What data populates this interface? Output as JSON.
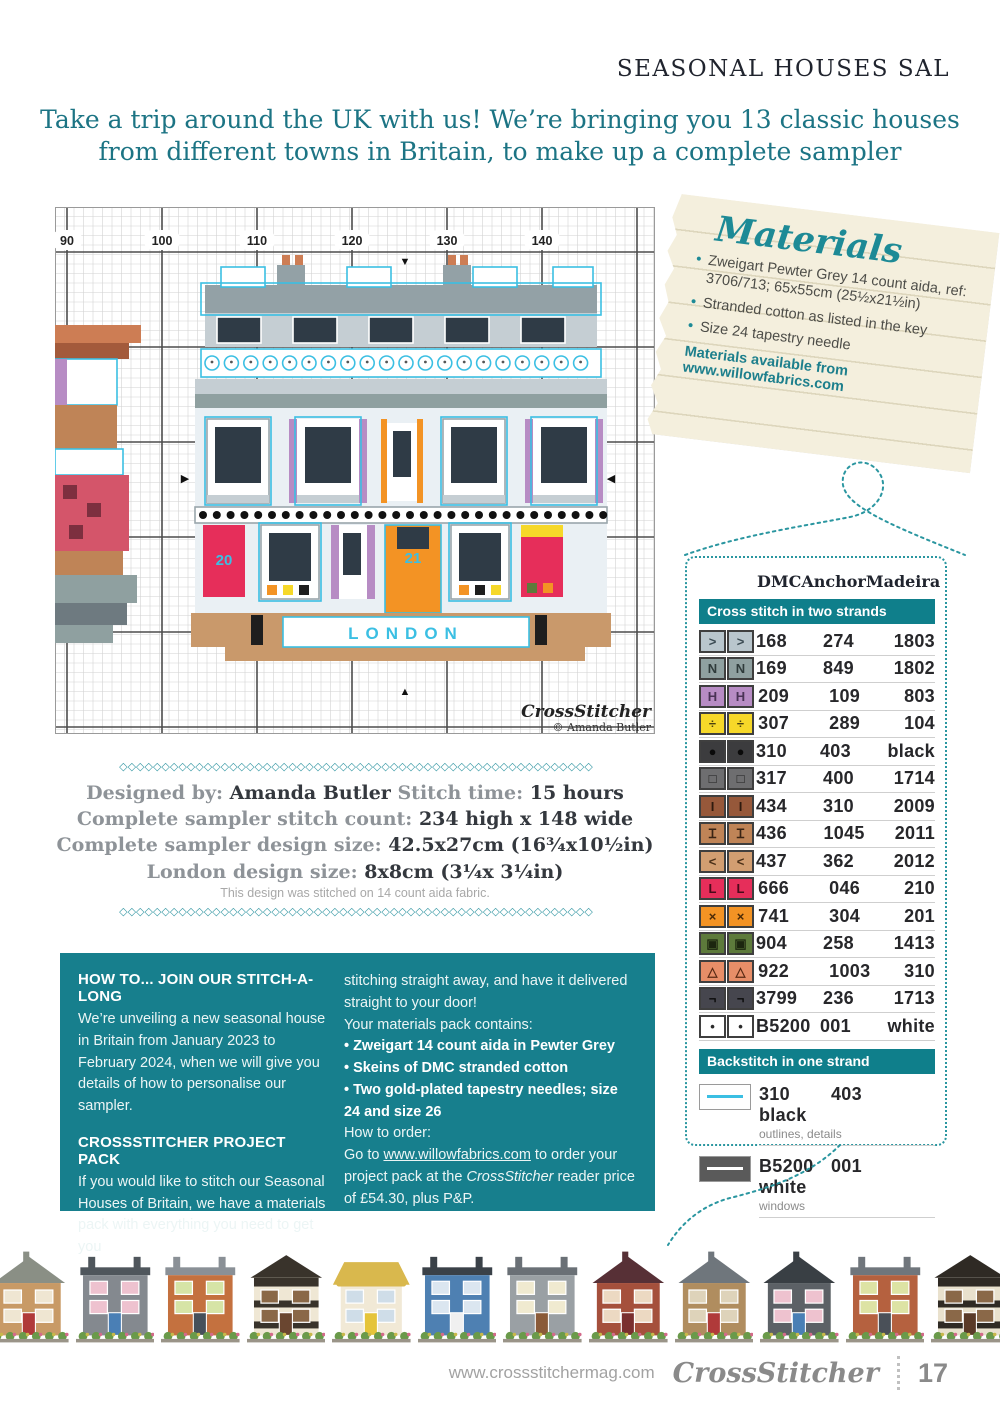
{
  "page": {
    "header": "SEASONAL HOUSES SAL",
    "intro_line1": "Take a trip around the UK with us! We’re bringing you 13 classic houses",
    "intro_line2": "from different towns in Britain, to make up a complete sampler",
    "decor_char": "◇"
  },
  "materials": {
    "title": "Materials",
    "items": [
      "Zweigart Pewter Grey 14 count aida, ref: 3706/713; 65x55cm (25½x21½in)",
      "Stranded cotton as listed in the key",
      "Size 24 tapestry needle"
    ],
    "availability": "Materials available from www.willowfabrics.com"
  },
  "chart": {
    "column_labels": [
      "90",
      "100",
      "110",
      "120",
      "130",
      "140"
    ],
    "caption_text": "LONDON",
    "watermark_logo": "CrossStitcher",
    "watermark_credit": "© Amanda Butler",
    "numbers": [
      {
        "t": "20",
        "x": 169,
        "y": 358
      },
      {
        "t": "21",
        "x": 358,
        "y": 356
      }
    ],
    "markers": [
      {
        "t": "▼",
        "x": 350,
        "y": 58
      },
      {
        "t": "▲",
        "x": 350,
        "y": 488
      },
      {
        "t": "▶",
        "x": 130,
        "y": 275
      },
      {
        "t": "◀",
        "x": 556,
        "y": 275
      }
    ],
    "frieze": {
      "x0": 157,
      "step": 19.4,
      "count": 20,
      "cy": 156,
      "r": 7
    },
    "rail": {
      "x0": 148,
      "step": 13.8,
      "count": 30,
      "cy": 308,
      "r": 4
    },
    "outlines": [
      {
        "x": 146,
        "y": 76,
        "w": 400,
        "h": 32
      },
      {
        "x": 150,
        "y": 210,
        "w": 66,
        "h": 88
      },
      {
        "x": 240,
        "y": 210,
        "w": 66,
        "h": 88
      },
      {
        "x": 386,
        "y": 210,
        "w": 66,
        "h": 88
      },
      {
        "x": 476,
        "y": 210,
        "w": 66,
        "h": 88
      },
      {
        "x": 204,
        "y": 316,
        "w": 62,
        "h": 78
      },
      {
        "x": 394,
        "y": 316,
        "w": 62,
        "h": 78
      }
    ],
    "blocks": [
      {
        "x": 0,
        "y": 118,
        "w": 86,
        "h": 18,
        "f": "#cd7d54"
      },
      {
        "x": 0,
        "y": 136,
        "w": 74,
        "h": 16,
        "f": "#a35a3b"
      },
      {
        "x": 0,
        "y": 152,
        "w": 62,
        "h": 46,
        "f": "#ffffff",
        "s": "#3bbfe3"
      },
      {
        "x": 0,
        "y": 152,
        "w": 12,
        "h": 46,
        "f": "#b78cc4"
      },
      {
        "x": 0,
        "y": 198,
        "w": 62,
        "h": 44,
        "f": "#bf8457"
      },
      {
        "x": 0,
        "y": 242,
        "w": 68,
        "h": 26,
        "f": "#ffffff",
        "s": "#3bbfe3"
      },
      {
        "x": 0,
        "y": 268,
        "w": 74,
        "h": 76,
        "f": "#d4556a"
      },
      {
        "x": 8,
        "y": 278,
        "w": 14,
        "h": 14,
        "f": "#7d2f3f"
      },
      {
        "x": 32,
        "y": 296,
        "w": 14,
        "h": 14,
        "f": "#7d2f3f"
      },
      {
        "x": 14,
        "y": 318,
        "w": 14,
        "h": 14,
        "f": "#7d2f3f"
      },
      {
        "x": 0,
        "y": 344,
        "w": 68,
        "h": 24,
        "f": "#bf8457"
      },
      {
        "x": 0,
        "y": 368,
        "w": 82,
        "h": 28,
        "f": "#8fa0a0"
      },
      {
        "x": 0,
        "y": 396,
        "w": 72,
        "h": 22,
        "f": "#6e7a80"
      },
      {
        "x": 0,
        "y": 418,
        "w": 58,
        "h": 18,
        "f": "#8fa0a0"
      },
      {
        "x": 140,
        "y": 200,
        "w": 412,
        "h": 206,
        "f": "#eaf0f4"
      },
      {
        "x": 150,
        "y": 78,
        "w": 392,
        "h": 28,
        "f": "#93a1a6"
      },
      {
        "x": 222,
        "y": 58,
        "w": 28,
        "h": 22,
        "f": "#93a1a6"
      },
      {
        "x": 388,
        "y": 58,
        "w": 28,
        "h": 22,
        "f": "#93a1a6"
      },
      {
        "x": 227,
        "y": 48,
        "w": 8,
        "h": 10,
        "f": "#cd7d54"
      },
      {
        "x": 240,
        "y": 48,
        "w": 8,
        "h": 10,
        "f": "#cd7d54"
      },
      {
        "x": 393,
        "y": 48,
        "w": 8,
        "h": 10,
        "f": "#cd7d54"
      },
      {
        "x": 405,
        "y": 48,
        "w": 8,
        "h": 10,
        "f": "#cd7d54"
      },
      {
        "x": 166,
        "y": 60,
        "w": 44,
        "h": 20,
        "f": "#ffffff",
        "s": "#3bbfe3"
      },
      {
        "x": 292,
        "y": 60,
        "w": 44,
        "h": 20,
        "f": "#ffffff",
        "s": "#3bbfe3"
      },
      {
        "x": 418,
        "y": 60,
        "w": 44,
        "h": 20,
        "f": "#ffffff",
        "s": "#3bbfe3"
      },
      {
        "x": 498,
        "y": 60,
        "w": 40,
        "h": 20,
        "f": "#ffffff",
        "s": "#3bbfe3"
      },
      {
        "x": 150,
        "y": 106,
        "w": 392,
        "h": 34,
        "f": "#c5ced3"
      },
      {
        "x": 162,
        "y": 110,
        "w": 44,
        "h": 26,
        "f": "#2f3b46",
        "s": "#ffffff"
      },
      {
        "x": 238,
        "y": 110,
        "w": 44,
        "h": 26,
        "f": "#2f3b46",
        "s": "#ffffff"
      },
      {
        "x": 314,
        "y": 110,
        "w": 44,
        "h": 26,
        "f": "#2f3b46",
        "s": "#ffffff"
      },
      {
        "x": 390,
        "y": 110,
        "w": 44,
        "h": 26,
        "f": "#2f3b46",
        "s": "#ffffff"
      },
      {
        "x": 466,
        "y": 110,
        "w": 44,
        "h": 26,
        "f": "#2f3b46",
        "s": "#ffffff"
      },
      {
        "x": 146,
        "y": 142,
        "w": 400,
        "h": 28,
        "f": "#ffffff",
        "s": "#3bbfe3"
      },
      {
        "x": 140,
        "y": 172,
        "w": 412,
        "h": 15,
        "f": "#c5ced3"
      },
      {
        "x": 140,
        "y": 187,
        "w": 412,
        "h": 14,
        "f": "#8fa0a0"
      },
      {
        "x": 152,
        "y": 212,
        "w": 62,
        "h": 84,
        "f": "#ffffff",
        "s": "#9aa6ac"
      },
      {
        "x": 160,
        "y": 220,
        "w": 46,
        "h": 56,
        "f": "#2f3b46"
      },
      {
        "x": 152,
        "y": 288,
        "w": 62,
        "h": 8,
        "f": "#c5ced3"
      },
      {
        "x": 234,
        "y": 212,
        "w": 8,
        "h": 84,
        "f": "#b78cc4"
      },
      {
        "x": 304,
        "y": 212,
        "w": 8,
        "h": 84,
        "f": "#b78cc4"
      },
      {
        "x": 242,
        "y": 212,
        "w": 62,
        "h": 84,
        "f": "#ffffff"
      },
      {
        "x": 250,
        "y": 220,
        "w": 46,
        "h": 56,
        "f": "#2f3b46"
      },
      {
        "x": 242,
        "y": 288,
        "w": 62,
        "h": 8,
        "f": "#c5ced3"
      },
      {
        "x": 326,
        "y": 212,
        "w": 6,
        "h": 84,
        "f": "#f39324"
      },
      {
        "x": 362,
        "y": 212,
        "w": 6,
        "h": 84,
        "f": "#f39324"
      },
      {
        "x": 332,
        "y": 216,
        "w": 30,
        "h": 78,
        "f": "#ffffff"
      },
      {
        "x": 338,
        "y": 224,
        "w": 18,
        "h": 46,
        "f": "#2f3b46"
      },
      {
        "x": 388,
        "y": 212,
        "w": 62,
        "h": 84,
        "f": "#ffffff",
        "s": "#9aa6ac"
      },
      {
        "x": 396,
        "y": 220,
        "w": 46,
        "h": 56,
        "f": "#2f3b46"
      },
      {
        "x": 388,
        "y": 288,
        "w": 62,
        "h": 8,
        "f": "#c5ced3"
      },
      {
        "x": 470,
        "y": 212,
        "w": 8,
        "h": 84,
        "f": "#b78cc4"
      },
      {
        "x": 540,
        "y": 212,
        "w": 8,
        "h": 84,
        "f": "#b78cc4"
      },
      {
        "x": 478,
        "y": 212,
        "w": 62,
        "h": 84,
        "f": "#ffffff"
      },
      {
        "x": 486,
        "y": 220,
        "w": 46,
        "h": 56,
        "f": "#2f3b46"
      },
      {
        "x": 478,
        "y": 288,
        "w": 62,
        "h": 8,
        "f": "#c5ced3"
      },
      {
        "x": 140,
        "y": 300,
        "w": 412,
        "h": 16,
        "f": "#ffffff",
        "s": "#9aa6ac"
      },
      {
        "x": 148,
        "y": 318,
        "w": 42,
        "h": 72,
        "f": "#e62e5a"
      },
      {
        "x": 206,
        "y": 318,
        "w": 58,
        "h": 74,
        "f": "#ffffff",
        "s": "#9aa6ac"
      },
      {
        "x": 214,
        "y": 326,
        "w": 42,
        "h": 48,
        "f": "#2f3b46"
      },
      {
        "x": 276,
        "y": 318,
        "w": 44,
        "h": 74,
        "f": "#ffffff"
      },
      {
        "x": 276,
        "y": 318,
        "w": 8,
        "h": 74,
        "f": "#b78cc4"
      },
      {
        "x": 312,
        "y": 318,
        "w": 8,
        "h": 74,
        "f": "#b78cc4"
      },
      {
        "x": 288,
        "y": 326,
        "w": 18,
        "h": 42,
        "f": "#2f3b46"
      },
      {
        "x": 330,
        "y": 318,
        "w": 56,
        "h": 88,
        "f": "#f39324",
        "s": "#3bbfe3"
      },
      {
        "x": 342,
        "y": 320,
        "w": 32,
        "h": 22,
        "f": "#2f3b46"
      },
      {
        "x": 396,
        "y": 318,
        "w": 58,
        "h": 74,
        "f": "#ffffff",
        "s": "#9aa6ac"
      },
      {
        "x": 404,
        "y": 326,
        "w": 42,
        "h": 48,
        "f": "#2f3b46"
      },
      {
        "x": 466,
        "y": 318,
        "w": 42,
        "h": 72,
        "f": "#e62e5a"
      },
      {
        "x": 466,
        "y": 318,
        "w": 42,
        "h": 12,
        "f": "#f6d829"
      },
      {
        "x": 212,
        "y": 378,
        "w": 10,
        "h": 10,
        "f": "#f39324"
      },
      {
        "x": 228,
        "y": 378,
        "w": 10,
        "h": 10,
        "f": "#f6d829"
      },
      {
        "x": 244,
        "y": 378,
        "w": 10,
        "h": 10,
        "f": "#1e1e1e"
      },
      {
        "x": 404,
        "y": 378,
        "w": 10,
        "h": 10,
        "f": "#f39324"
      },
      {
        "x": 420,
        "y": 378,
        "w": 10,
        "h": 10,
        "f": "#1e1e1e"
      },
      {
        "x": 436,
        "y": 378,
        "w": 10,
        "h": 10,
        "f": "#f6d829"
      },
      {
        "x": 472,
        "y": 376,
        "w": 10,
        "h": 10,
        "f": "#5d7a3b"
      },
      {
        "x": 488,
        "y": 376,
        "w": 10,
        "h": 10,
        "f": "#f39324"
      },
      {
        "x": 136,
        "y": 406,
        "w": 420,
        "h": 34,
        "f": "#c9996b"
      },
      {
        "x": 170,
        "y": 440,
        "w": 360,
        "h": 14,
        "f": "#c9996b"
      },
      {
        "x": 196,
        "y": 408,
        "w": 12,
        "h": 30,
        "f": "#1e1e1e"
      },
      {
        "x": 480,
        "y": 408,
        "w": 12,
        "h": 30,
        "f": "#1e1e1e"
      },
      {
        "x": 228,
        "y": 410,
        "w": 246,
        "h": 30,
        "f": "#ffffff",
        "s": "#3bbfe3"
      }
    ]
  },
  "key": {
    "columns": [
      "DMC",
      "Anchor",
      "Madeira"
    ],
    "section1": "Cross stitch in two strands",
    "rows": [
      {
        "symbol": ">",
        "bg": "#b9c6cd",
        "sc": "#3a4a52",
        "dmc": "168",
        "anchor": "274",
        "madeira": "1803"
      },
      {
        "symbol": "N",
        "bg": "#8fa0a0",
        "sc": "#2f3b3b",
        "dmc": "169",
        "anchor": "849",
        "madeira": "1802"
      },
      {
        "symbol": "H",
        "bg": "#b78cc4",
        "sc": "#4a3356",
        "dmc": "209",
        "anchor": "109",
        "madeira": "803"
      },
      {
        "symbol": "÷",
        "bg": "#f6d829",
        "sc": "#4a4210",
        "dmc": "307",
        "anchor": "289",
        "madeira": "104"
      },
      {
        "symbol": "●",
        "bg": "#3c3c3e",
        "sc": "#0a0a0a",
        "dmc": "310",
        "anchor": "403",
        "madeira": "black"
      },
      {
        "symbol": "□",
        "bg": "#6e6e70",
        "sc": "#1e1e1e",
        "dmc": "317",
        "anchor": "400",
        "madeira": "1714"
      },
      {
        "symbol": "I",
        "bg": "#96583a",
        "sc": "#2e1a0e",
        "dmc": "434",
        "anchor": "310",
        "madeira": "2009"
      },
      {
        "symbol": "Ɪ",
        "bg": "#bf8457",
        "sc": "#3a2414",
        "dmc": "436",
        "anchor": "1045",
        "madeira": "2011"
      },
      {
        "symbol": "<",
        "bg": "#d29e71",
        "sc": "#4a3018",
        "dmc": "437",
        "anchor": "362",
        "madeira": "2012"
      },
      {
        "symbol": "L",
        "bg": "#e62e5a",
        "sc": "#4a0a1a",
        "dmc": "666",
        "anchor": "046",
        "madeira": "210"
      },
      {
        "symbol": "×",
        "bg": "#f39324",
        "sc": "#4a2a08",
        "dmc": "741",
        "anchor": "304",
        "madeira": "201"
      },
      {
        "symbol": "▣",
        "bg": "#5d7a3b",
        "sc": "#1c260f",
        "dmc": "904",
        "anchor": "258",
        "madeira": "1413"
      },
      {
        "symbol": "△",
        "bg": "#e78e68",
        "sc": "#5a2a14",
        "dmc": "922",
        "anchor": "1003",
        "madeira": "310"
      },
      {
        "symbol": "¬",
        "bg": "#46464e",
        "sc": "#0a0a0a",
        "dmc": "3799",
        "anchor": "236",
        "madeira": "1713"
      },
      {
        "symbol": "•",
        "bg": "#ffffff",
        "sc": "#2a2a2a",
        "dmc": "B5200",
        "anchor": "001",
        "madeira": "white"
      }
    ],
    "section2": "Backstitch in one strand",
    "backstitch": [
      {
        "box": "#ffffff",
        "line": "#3bbfe3",
        "dmc": "310",
        "anchor": "403",
        "madeira": "black",
        "note": "outlines, details"
      },
      {
        "box": "#5a5a5a",
        "line": "#ffffff",
        "dmc": "B5200",
        "anchor": "001",
        "madeira": "white",
        "note": "windows"
      }
    ]
  },
  "details": {
    "designed_by_label": "Designed by:",
    "designed_by": "Amanda Butler",
    "stitch_time_label": "Stitch time:",
    "stitch_time": "15 hours",
    "count_label": "Complete sampler stitch count:",
    "count_value": "234 high x 148 wide",
    "size_label": "Complete sampler design size:",
    "size_value": "42.5x27cm (16¾x10½in)",
    "london_label": "London design size:",
    "london_value": "8x8cm (3¼x 3¼in)",
    "note": "This design was stitched on 14 count aida fabric."
  },
  "howto": {
    "h1": "HOW TO... JOIN OUR STITCH-A-LONG",
    "p1": "We’re unveiling a new seasonal house in Britain from January 2023 to February 2024, when we will give you details of how to personalise our sampler.",
    "h2": "CROSSSTITCHER PROJECT PACK",
    "p2": "If you would like to stitch our Seasonal Houses of Britain, we have a materials pack with everything you need to get you",
    "col2_intro": "stitching straight away, and have it delivered straight to your door!",
    "contains_label": "Your materials pack contains:",
    "bullets": [
      "Zweigart 14 count aida in Pewter Grey",
      "Skeins of DMC stranded cotton",
      "Two gold-plated tapestry needles; size 24 and size 26"
    ],
    "order_label": "How to order:",
    "order_pre": "Go to ",
    "order_url": "www.willowfabrics.com",
    "order_mid": " to order your project pack at the ",
    "order_brand": "CrossStitcher",
    "order_post": " reader price of £54.30, plus P&P."
  },
  "houses_strip": [
    {
      "style": "gable",
      "wall": "#c89a66",
      "roof": "#8a8f85",
      "door": "#b03a3a",
      "win": "#efe6d2"
    },
    {
      "style": "flat",
      "wall": "#84898f",
      "roof": "#4f565c",
      "door": "#4a7fb5",
      "win": "#eec2cf"
    },
    {
      "style": "flat",
      "wall": "#c4713f",
      "roof": "#8a9096",
      "door": "#46505a",
      "win": "#d6e4a6"
    },
    {
      "style": "tudor",
      "wall": "#efe7d4",
      "roof": "#39332b",
      "door": "#6a4630",
      "win": "#8a6848"
    },
    {
      "style": "thatch",
      "wall": "#f1e9d6",
      "roof": "#d9b84d",
      "door": "#e5c43a",
      "win": "#cfdde8"
    },
    {
      "style": "flat",
      "wall": "#4e80b2",
      "roof": "#3a4148",
      "door": "#f0f0f0",
      "win": "#dbe6f0"
    },
    {
      "style": "flat",
      "wall": "#9aa0a4",
      "roof": "#6a7076",
      "door": "#8a5a38",
      "win": "#f0ead0"
    },
    {
      "style": "gable",
      "wall": "#a5503c",
      "roof": "#573036",
      "door": "#7a2f2f",
      "win": "#ecd9c2"
    },
    {
      "style": "gable",
      "wall": "#b08d5f",
      "roof": "#6f767c",
      "door": "#b03a3a",
      "win": "#ded3ba"
    },
    {
      "style": "gable",
      "wall": "#5c6166",
      "roof": "#393f44",
      "door": "#4a7fb5",
      "win": "#eec2cf"
    },
    {
      "style": "flat",
      "wall": "#b5613f",
      "roof": "#70767c",
      "door": "#4a5058",
      "win": "#dde3a4"
    },
    {
      "style": "tudor",
      "wall": "#e9e1cd",
      "roof": "#2f2a24",
      "door": "#5a3a28",
      "win": "#8a6848"
    }
  ],
  "footer": {
    "url": "www.crossstitchermag.com",
    "logo": "CrossStitcher",
    "page_number": "17"
  }
}
